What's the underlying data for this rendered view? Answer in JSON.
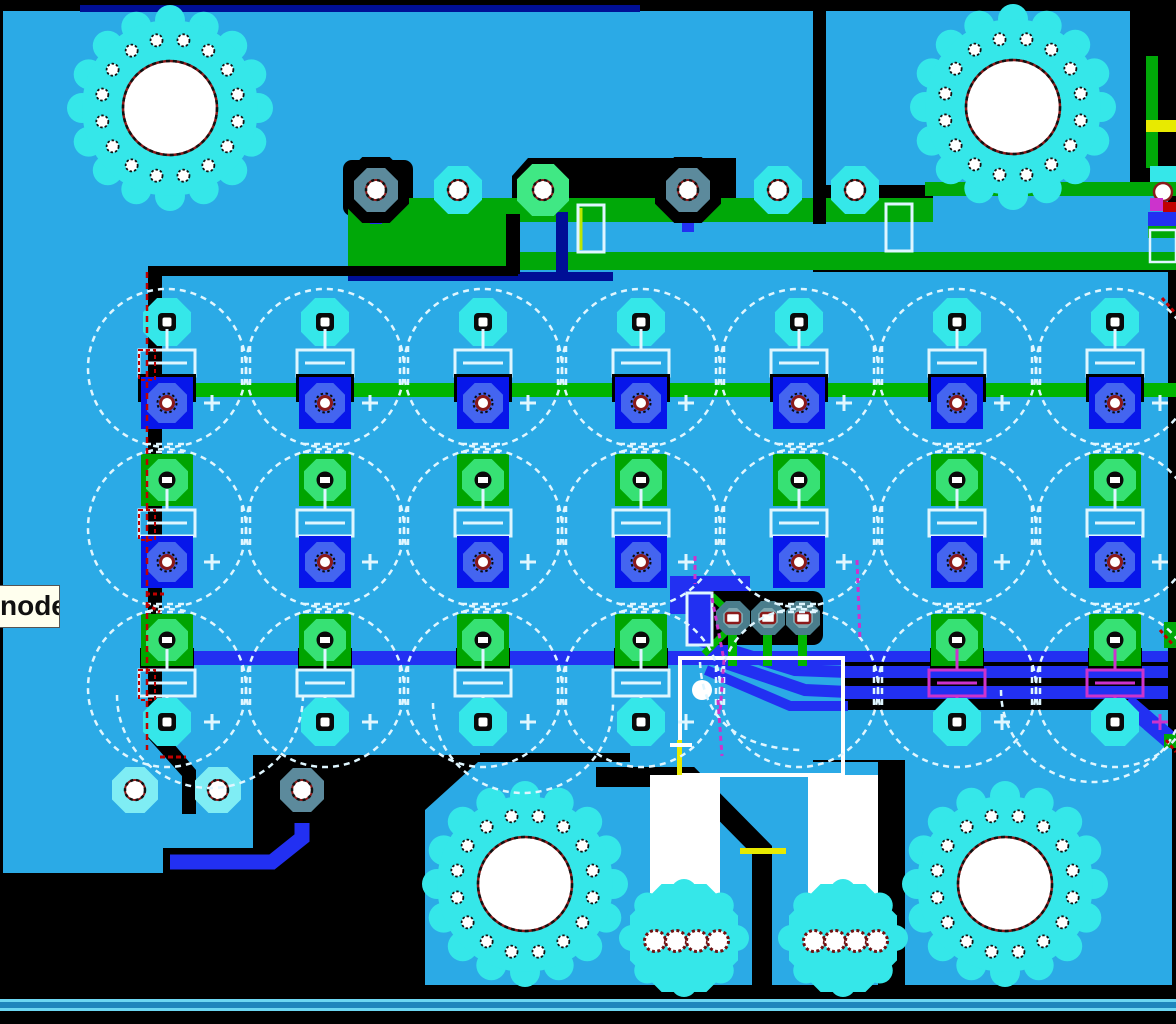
{
  "app": {
    "view": "pcb-layout-editor-viewport"
  },
  "tooltip": {
    "text": "node"
  },
  "palette": {
    "black": "#000000",
    "pour": "#2BAAE6",
    "aqua": "#35E7E9",
    "aquaLight": "#7FEDF4",
    "copperGreen": "#00A808",
    "traceGreen": "#00B400",
    "mint": "#40E884",
    "padGreenSq": "#00A400",
    "padGreenOct": "#37E174",
    "royalSq": "#0716EA",
    "royalOct": "#4465F0",
    "royalTrace": "#2230F2",
    "navy": "#000F96",
    "grayVia": "#5C8A9C",
    "tealVia": "#4A7D8C",
    "tealViaLight": "#7FA8B0",
    "silk": "#DFF6FF",
    "white": "#FFFFFF",
    "magenta": "#CC33CC",
    "yellow": "#E8EA00",
    "red": "#C00000",
    "darkRed": "#8B1A1A",
    "stripCyan": "#6CD6F2",
    "stripBlue": "#1E85BD",
    "tooltipBg": "#FFFFEE"
  },
  "board": {
    "capacitor_grid": {
      "columns": 7,
      "rows": 3,
      "silkscreen_circles": 21,
      "polarity_mark": "+"
    },
    "mounting_holes": {
      "count": 4,
      "ring_vias_per_hole": 16
    },
    "connector_pads": {
      "count": 2,
      "holes_per_pad": 4
    },
    "via_cluster": {
      "vias": 3
    }
  }
}
